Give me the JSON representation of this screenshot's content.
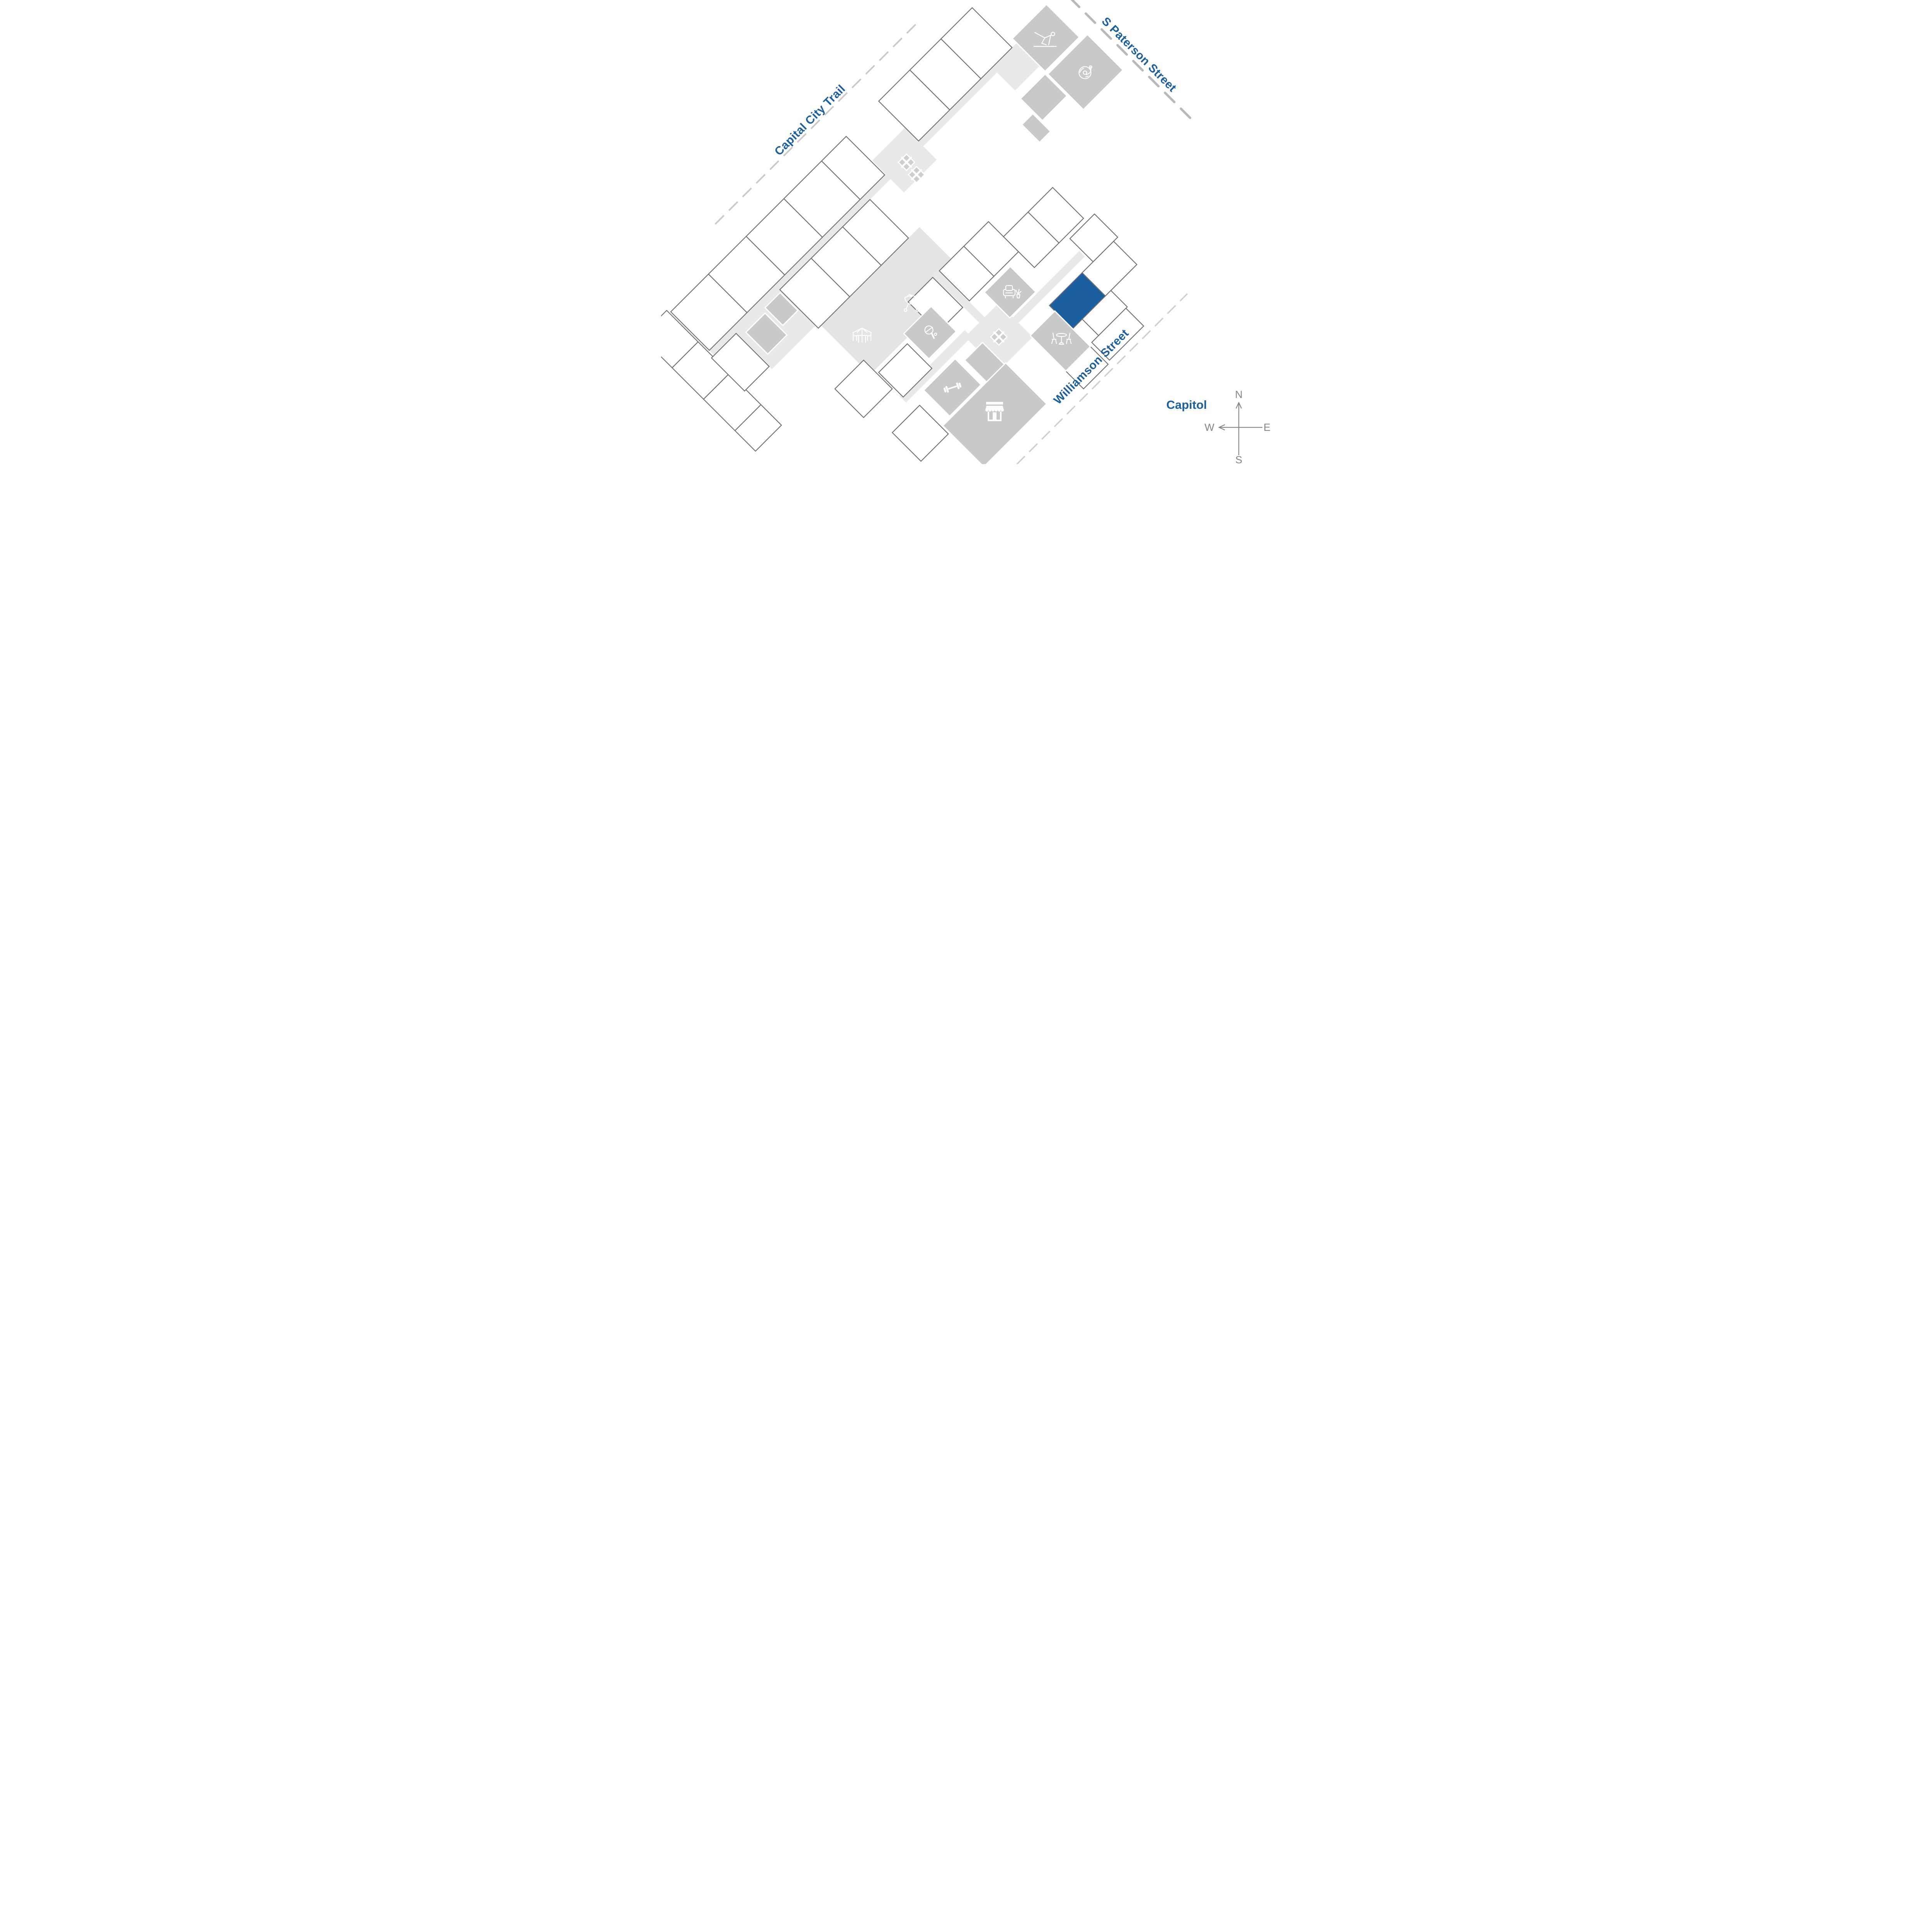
{
  "labels": {
    "capital_city_trail": "Capital City Trail",
    "s_paterson_street": "S Paterson Street",
    "williamson_street": "Williamson Street",
    "capitol": "Capitol"
  },
  "compass": {
    "north": "N",
    "south": "S",
    "east": "E",
    "west": "W"
  },
  "highlighted_unit": {
    "color": "#1b5f9e"
  },
  "amenity_icons": [
    "yoga-icon",
    "vinyl-record-icon",
    "bbq-grill-icon",
    "patio-umbrella-icon",
    "armchair-icon",
    "table-tennis-icon",
    "dumbbell-icon",
    "market-icon",
    "cafe-table-icon",
    "stairs-x-icon"
  ],
  "colors": {
    "accent": "#1b5f9e",
    "label_blue": "#1b5f9e",
    "unit_outline": "#6f7073",
    "unit_fill": "#ffffff",
    "corridor": "#e9e9eb",
    "courtyard": "#e4e4e6",
    "amenity_room": "#c9c9cc",
    "stair_fill": "#cfcfd2",
    "trail_dash": "#c9c9cb",
    "paterson_dash": "#b9b9bb",
    "williamson_dash": "#d0d0d2",
    "compass_gray": "#85868a",
    "icon_white": "#ffffff"
  }
}
